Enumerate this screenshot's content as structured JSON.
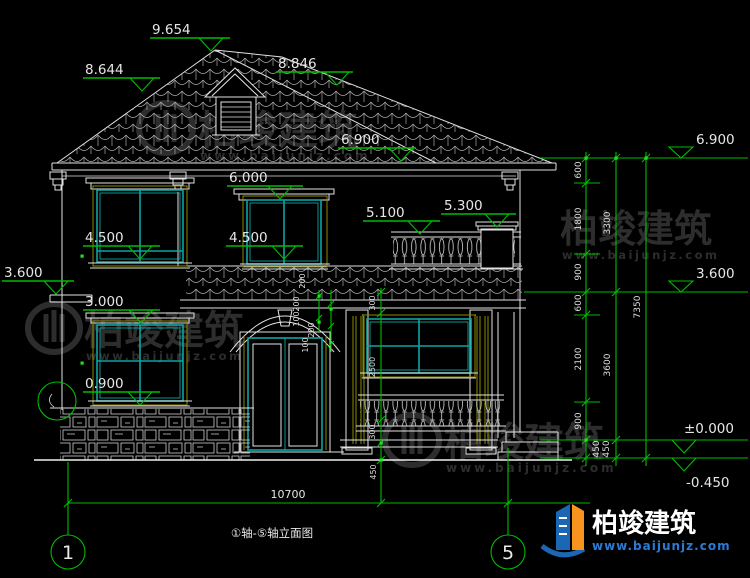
{
  "drawing_type": "house front elevation CAD drawing",
  "labels": {
    "peak": "9.654",
    "roof_left": "8.644",
    "roof_right": "8.846",
    "eave_center": "6.900",
    "window_top_2f": "6.000",
    "balcony_floor": "5.100",
    "balcony_rail": "5.300",
    "sill_2f_left": "4.500",
    "sill_2f_center": "4.500",
    "floor_2f_left": "3.600",
    "window_top_1f": "3.000",
    "sill_1f": "0.900",
    "eave_right": "6.900",
    "floor_2f_right": "3.600",
    "ground_level": "±0.000",
    "grade_level": "-0.450"
  },
  "chains": {
    "right_inner": [
      "600",
      "1800",
      "900",
      "600",
      "2100",
      "900",
      "450"
    ],
    "right_mid": [
      "3300",
      "3600",
      "450"
    ],
    "right_outer": "7350",
    "porch": [
      "300",
      "2500",
      "300",
      "450"
    ],
    "arch": [
      "200",
      "200",
      "100",
      "200",
      "100"
    ],
    "bottom_overall": "10700"
  },
  "grid": {
    "bubble_left": "1",
    "bubble_right": "5"
  },
  "title": {
    "text": "①轴-⑤轴立面图"
  },
  "watermark": {
    "brand": "柏竣建筑",
    "url": "www.baijunjz.com"
  },
  "logo": {
    "brand": "柏竣建筑",
    "url": "www.baijunjz.com"
  },
  "colors": {
    "background": "#000000",
    "line_white": "#e2e2e2",
    "dimension_green": "#00bd00",
    "grip_green": "#1ee21e",
    "window_teal": "#0fa3a3",
    "trim_olive": "#8a8a00",
    "watermark_gray": "#2d2d2d",
    "logo_blue": "#1b67b3",
    "logo_orange": "#f7941e",
    "logo_url_blue": "#2b7bd4"
  }
}
